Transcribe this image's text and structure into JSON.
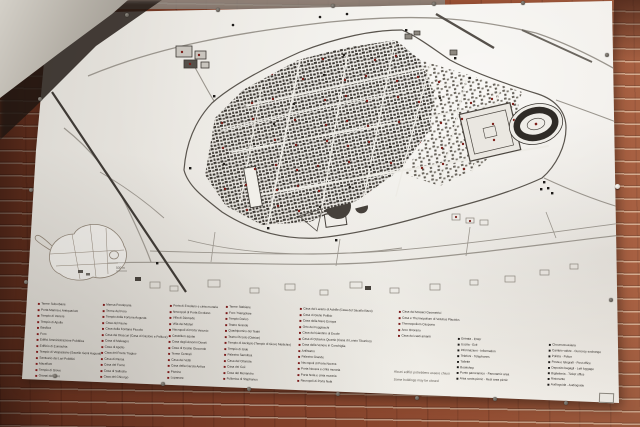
{
  "legend": {
    "monument_columns": [
      {
        "items": [
          "Terme Suburbane",
          "Porta Marina e Antiquarium",
          "Tempio di Venere",
          "Tempio di Apollo",
          "Basilica",
          "Foro",
          "Edifici Amministrazione Pubblica",
          "Edificio di Eumachia",
          "Tempio di Vespasiano (Sacello Genii Augusti)",
          "Santuario dei Lari Pubblici",
          "Macellum",
          "Tempio di Giove",
          "Granai del Foro"
        ]
      },
      {
        "items": [
          "Mensa Ponderaria",
          "Terme del Foro",
          "Tempio della Fortuna Augusta",
          "Casa del Fauno",
          "Casa della Fontana Piccola",
          "Casa dei Dioscuri (Casa di Castore e Polluce)",
          "Casa di Meleagro",
          "Casa di Apollo",
          "Casa del Poeta Tragico",
          "Casa di Pansa",
          "Casa del Forno",
          "Casa di Sallustio",
          "Casa del Chirurgo"
        ]
      },
      {
        "items": [
          "Porta di Ercolano e cinta muraria",
          "Necropoli di Porta Ercolano",
          "Villa di Diomede",
          "Villa dei Misteri",
          "Necropoli di Porta Vesuvio",
          "Castellum aquae",
          "Casa degli Amorini Dorati",
          "Casa di Cecilio Giocondo",
          "Terme Centrali",
          "Casa dei Vettii",
          "Casa della Caccia Antica",
          "Pistrino",
          "Lupanare"
        ]
      },
      {
        "items": [
          "Terme Stabiane",
          "Foro Triangolare",
          "Tempio Dorico",
          "Teatro Grande",
          "Quadriportico dei Teatri",
          "Teatro Piccolo (Odeion)",
          "Tempio di Asclepio (Tempio di Giove Meilichio)",
          "Tempio di Iside",
          "Palestra Sannitica",
          "Casa del Citarista",
          "Casa dei Ceii",
          "Casa del Menandro",
          "Fullonica di Stephanus"
        ]
      },
      {
        "items": [
          "Casa del Larario di Achille (Casa del Sacello Iliaco)",
          "Casa di Giulio Polibio",
          "Casa della Nave Europa",
          "Orto dei Fuggiaschi",
          "Casa del Giardino di Ercole",
          "Casa di Octavius Quartio (Casa di Loreio Tiburtino)",
          "Casa della Venere in Conchiglia",
          "Anfiteatro",
          "Palestra Grande",
          "Necropoli di Porta Nocera",
          "Porta Nocera e cinta muraria",
          "Porta Nola e cinta muraria",
          "Necropoli di Porta Nola"
        ]
      },
      {
        "items": [
          "Casa dei Mosaici Geometrici",
          "Casa e Thermopolium di Vetutius Placidus",
          "Thermopolium Caupona",
          "Arco Onorario",
          "Casa dei casti amanti"
        ]
      }
    ],
    "facility_columns": [
      {
        "items": [
          "Entrata - Enter",
          "Uscita - Exit",
          "Informazioni - Information",
          "Telefoni - Telephones",
          "Toilette",
          "Bookshop",
          "Punto panoramico - Panoramic area",
          "Area sosta picnic - Rest area picnic"
        ]
      },
      {
        "items": [
          "Circumvesuviana",
          "Cambio valute - Currency exchange",
          "Polizia - Police",
          "Posta e telegrafi - Post office",
          "Deposito bagagli - Left luggage",
          "Biglietteria - Ticket office",
          "Ristorante",
          "Audioguida - Audioguide"
        ]
      }
    ]
  },
  "note": {
    "line1": "Alcuni edifici potrebbero essere chiusi",
    "line2": "Some buildings may be closed"
  },
  "inset": {
    "scale_label": "500 m"
  },
  "colors": {
    "legend_bullet_red": "#7a1a1a",
    "facility_bullet_black": "#1c1a18",
    "map_poi_red": "#7c1f1a",
    "sign_white": "#efede8",
    "brick": "#94492f",
    "map_line": "#3c3833"
  }
}
